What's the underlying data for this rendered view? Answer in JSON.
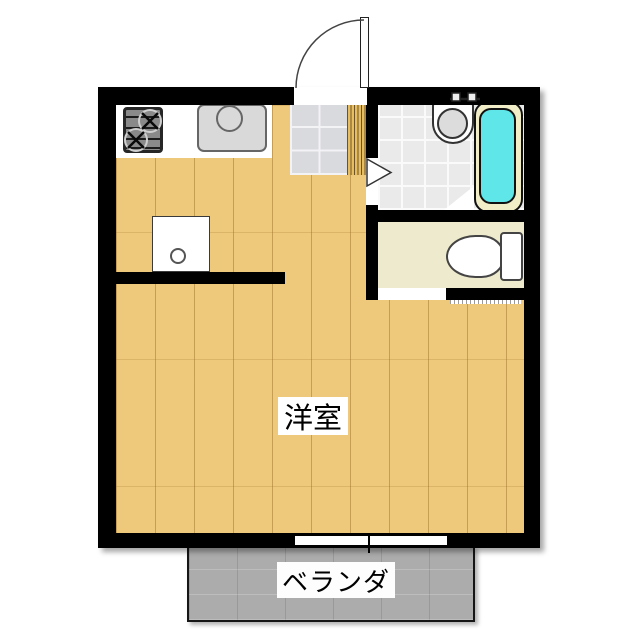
{
  "floorplan": {
    "main_room_label": "洋室",
    "balcony_label": "ベランダ",
    "fixtures": [
      "entry-door-swing",
      "gas-stove",
      "kitchen-sink",
      "washing-machine-pan",
      "wash-basin",
      "bathtub",
      "toilet",
      "bathroom-door-swing",
      "balcony-sliding-window"
    ],
    "colors": {
      "wall": "#000000",
      "wood_floor": "#eec97b",
      "plank_line": "#c8a055",
      "entry_tile": "#d9dade",
      "bath_tile": "#eaeaea",
      "toilet_floor": "#edeacd",
      "tub_water": "#5fe6e8",
      "tub_rim": "#f1edc7",
      "balcony_gray": "#acacac",
      "counter": "#ffffff"
    }
  }
}
